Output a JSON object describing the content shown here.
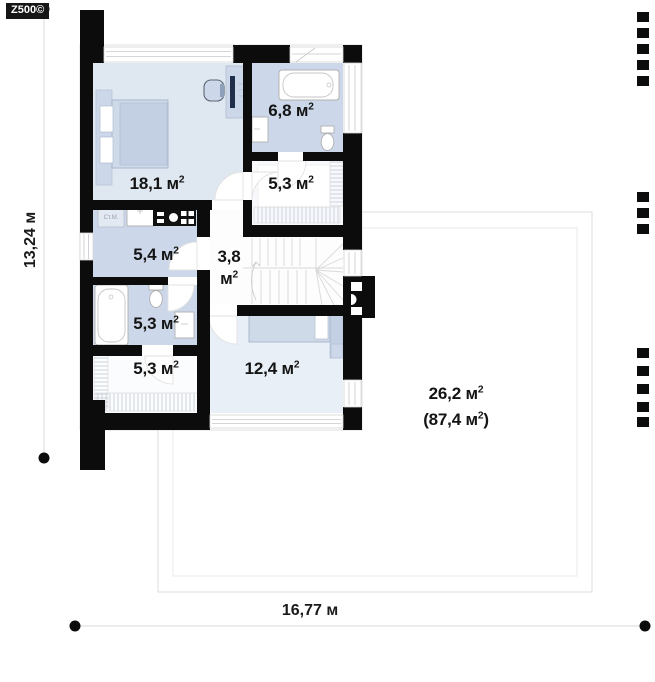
{
  "logo": {
    "text": "Z500©"
  },
  "dimensions": {
    "height_label": "13,24 м",
    "width_label": "16,77 м"
  },
  "rooms": {
    "bedroom": {
      "name": "bedroom",
      "area": "18,1 м²"
    },
    "bathroom_top": {
      "name": "bathroom",
      "area": "6,8 м²"
    },
    "closet_top": {
      "name": "closet",
      "area": "5,3 м²"
    },
    "laundry": {
      "name": "laundry",
      "area": "5,4 м²"
    },
    "hall": {
      "name": "hall",
      "area_value": "3,8",
      "area_unit": "м²"
    },
    "bathroom_left": {
      "name": "bathroom",
      "area": "5,3 м²"
    },
    "wardrobe": {
      "name": "wardrobe",
      "area": "5,3 м²"
    },
    "bedroom_small": {
      "name": "small bedroom",
      "area": "12,4 м²"
    }
  },
  "attic": {
    "usable_area": "26,2 м²",
    "total_area": "(87,4 м²)"
  },
  "labels": {
    "washing_machine": "Ст.М."
  },
  "colors": {
    "wall": "#0c0c0c",
    "room_fill": "#ccd8e9",
    "room_fill_light": "#dfe7f1",
    "room_fill_pale": "#e9eff7",
    "dimension_line": "#d9d9d9"
  }
}
